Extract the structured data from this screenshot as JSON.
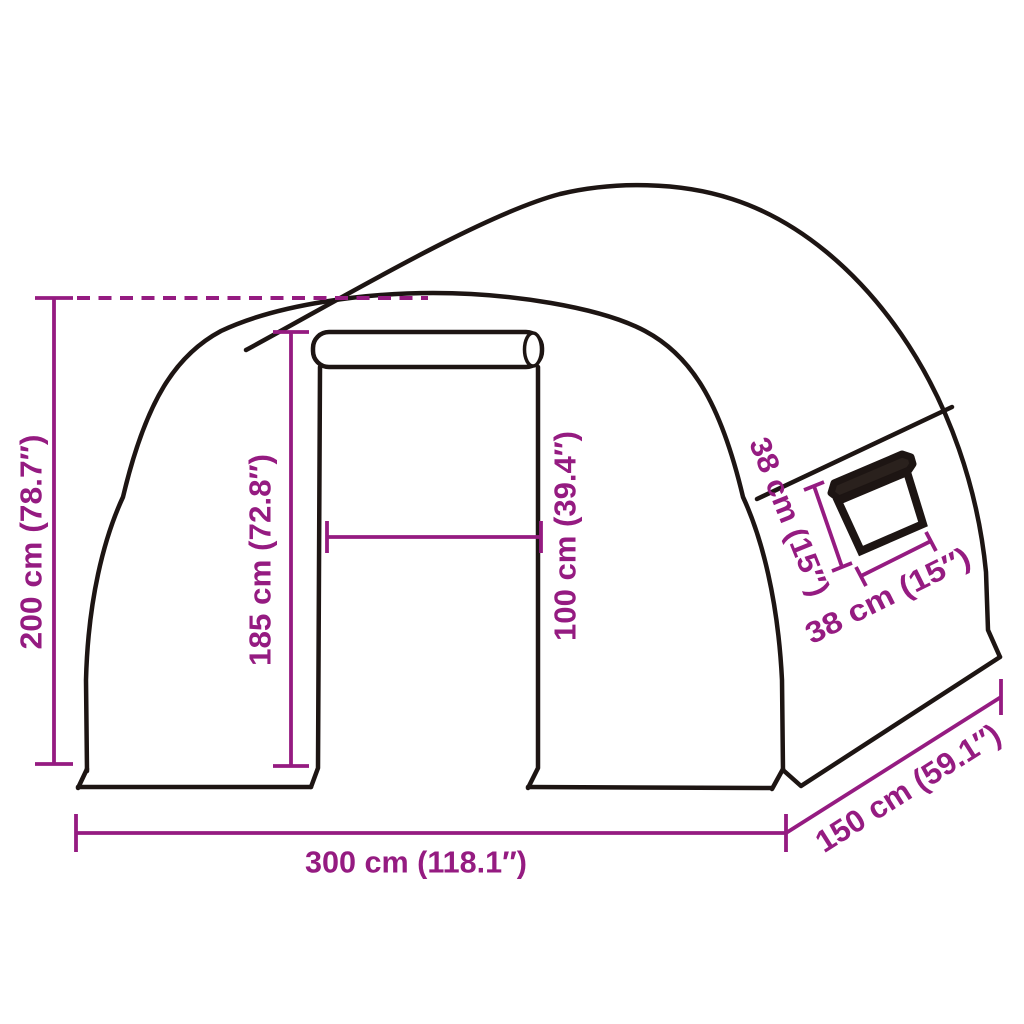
{
  "diagram": {
    "title": "Greenhouse tunnel dimension diagram",
    "outline_color": "#1d1513",
    "dimension_color": "#951b81",
    "window_flap_color": "#2a211d",
    "labels": {
      "total_height": "200 cm (78.7″)",
      "door_height": "185 cm (72.8″)",
      "door_width": "100 cm (39.4″)",
      "window_height": "38 cm (15″)",
      "window_width": "38 cm (15″)",
      "total_width": "300 cm (118.1″)",
      "total_depth": "150 cm (59.1″)"
    }
  }
}
